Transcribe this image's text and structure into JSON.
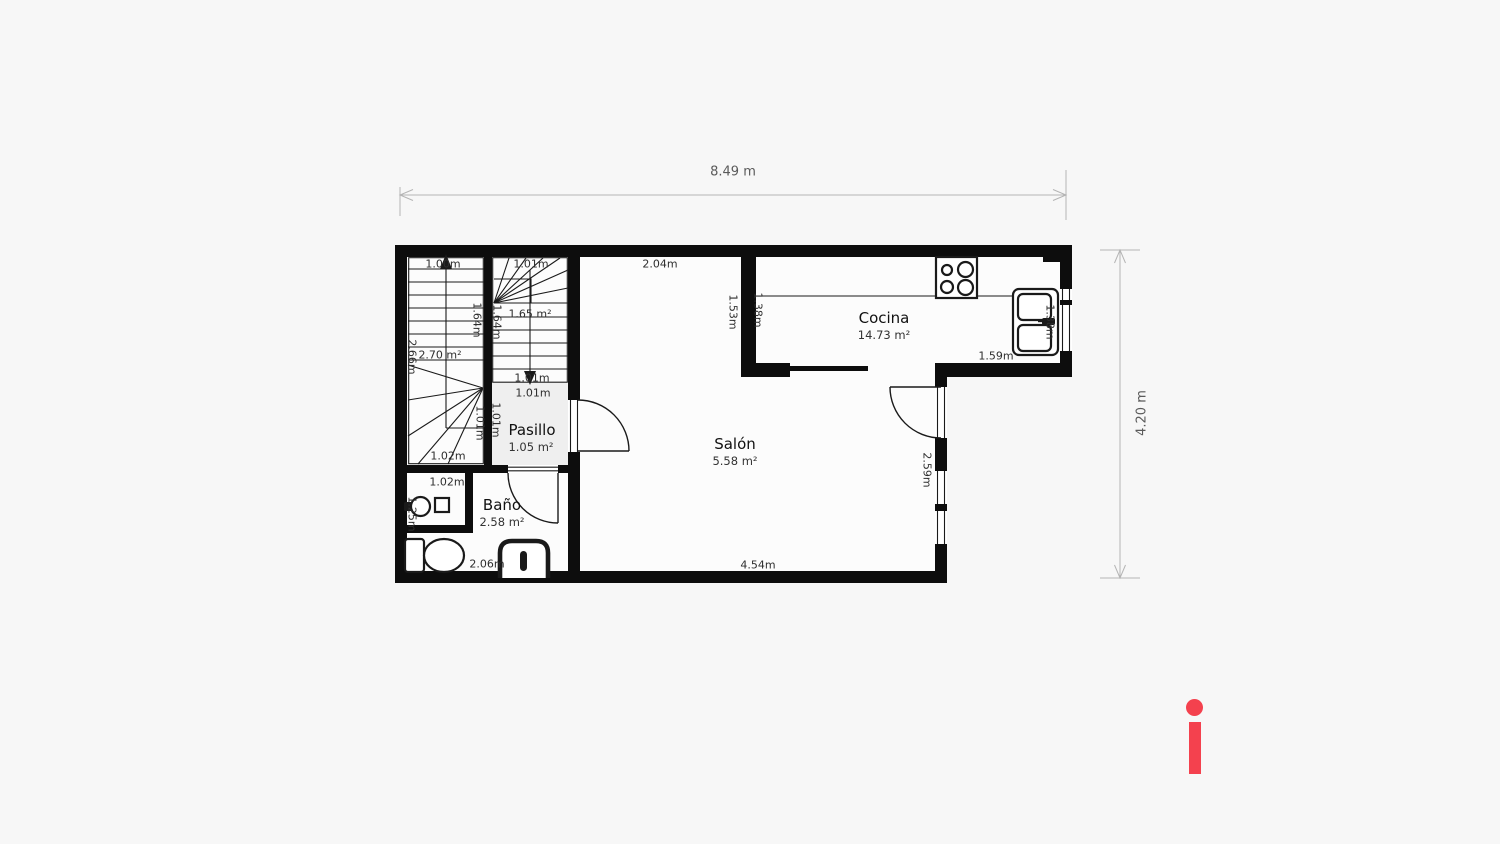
{
  "plan": {
    "overall": {
      "width_label": "8.49 m",
      "height_label": "4.20 m"
    },
    "rooms": {
      "cocina": {
        "name": "Cocina",
        "area": "14.73 m²"
      },
      "salon": {
        "name": "Salón",
        "area": "5.58 m²"
      },
      "pasillo": {
        "name": "Pasillo",
        "area": "1.05 m²"
      },
      "bano": {
        "name": "Baño",
        "area": "2.58 m²"
      }
    },
    "dims": {
      "stair_left_width": "1.00m",
      "stair_left_run": "1.64m",
      "stair_left_height": "2.66m",
      "stair_left_area": "2.70 m²",
      "stair_left_inner": "1.01m",
      "stair_left_bottom": "1.02m",
      "stair_right_width": "1.01m",
      "stair_right_area": "1.65 m²",
      "stair_right_run": "1.64m",
      "stair_right_bottom": "1.01m",
      "pasillo_width": "1.01m",
      "pasillo_depth": "1.01m",
      "bano_vanity_width": "1.02m",
      "bano_vanity_depth": "1.25m",
      "bano_width": "2.06m",
      "salon_top": "2.04m",
      "salon_wall": "1.53m",
      "salon_bottom": "4.54m",
      "salon_window": "2.59m",
      "cocina_wall": "1.38m",
      "cocina_counter": "1.59m",
      "cocina_sink": "1.38m"
    },
    "icons": {
      "stove": "stove-burners-icon",
      "kitchen_sink": "double-sink-icon",
      "washbasin": "washbasin-icon",
      "toilet": "toilet-icon",
      "shower": "shower-icon",
      "stairs_up": "staircase-up-arrow-icon",
      "stairs_down": "staircase-down-arrow-icon"
    }
  },
  "watermark": {
    "letter": "i",
    "color": "#f4414e"
  },
  "colors": {
    "page_bg": "#f7f7f7",
    "wall": "#0d0d0d",
    "floor": "#fcfcfc",
    "hall_floor": "#efefef",
    "dim_line": "#b4b4b4",
    "dim_text": "#2e2e2e",
    "outer_dim_text": "#5a5a5a",
    "logo": "#f4414e"
  }
}
